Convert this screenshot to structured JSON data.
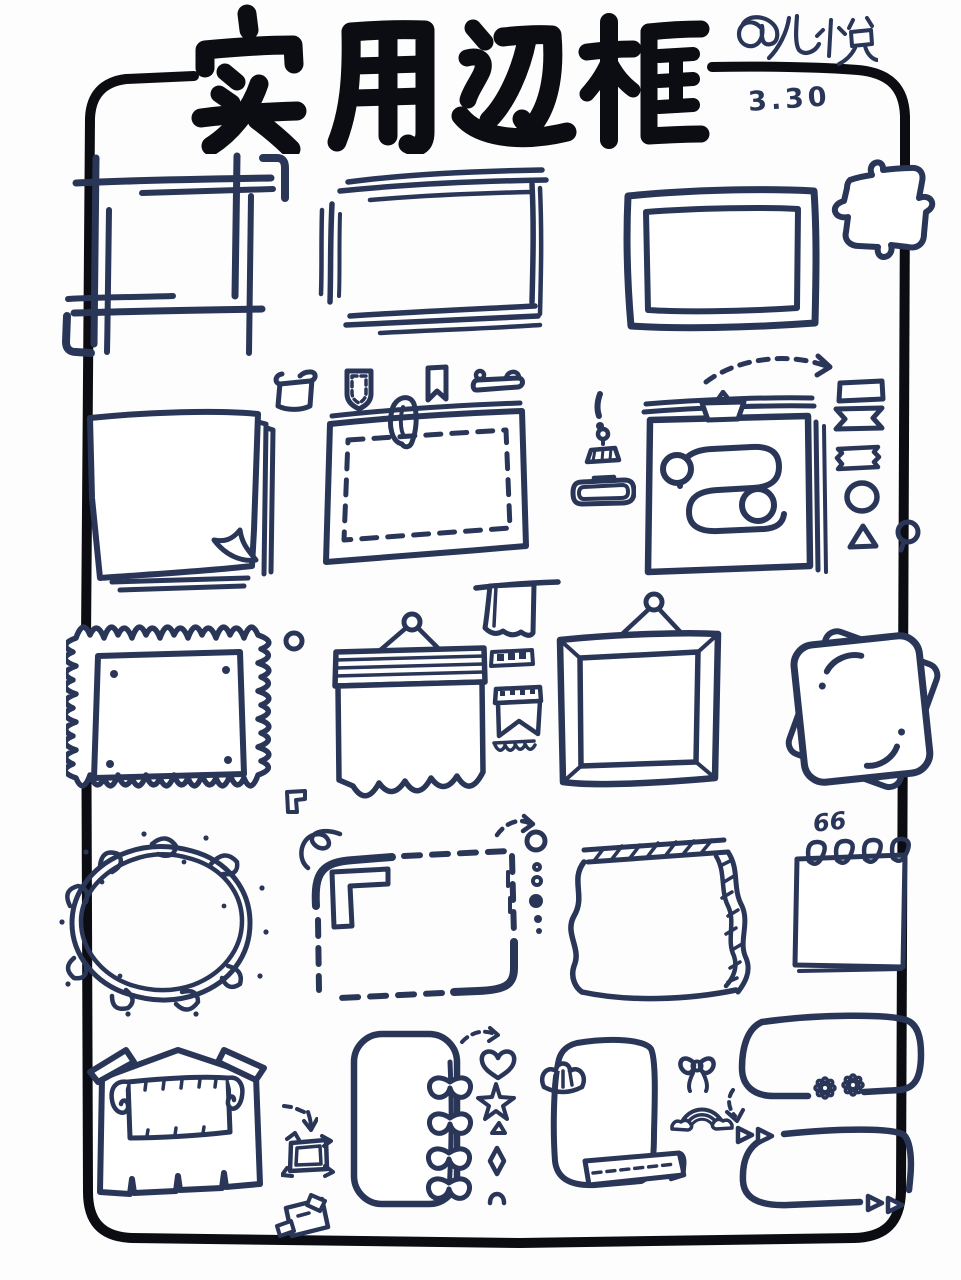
{
  "header": {
    "title": "实用边框",
    "title_meaning": "Practical Borders",
    "author": "@九悦",
    "date": "3.30"
  },
  "quote_pad": {
    "marks": "66"
  },
  "colors": {
    "ink": "#2a3658",
    "outline": "#0c0d12",
    "paper": "#ffffff"
  },
  "doodles": [
    "outer-border",
    "crop-marks-frame",
    "sketch-lines-frame",
    "double-border-frame",
    "puzzle-piece",
    "stacked-paper-frame",
    "scroll-icon",
    "pocket-icon",
    "bookmark-icon",
    "clamp-icon",
    "paperclip-dashed-frame",
    "exclamation-icon",
    "binder-clip-icon",
    "nameplate-icon",
    "collage-frame",
    "dashed-arc-arrow",
    "banner-rect-icon",
    "ribbon-banner-icon",
    "washi-tape-icon",
    "circle-icon",
    "triangle-icon",
    "speech-bubble-icon",
    "stamp-frame",
    "dot-circle-icon",
    "hanging-banner-frame",
    "towel-icon",
    "film-strip-icon",
    "pennant-icon",
    "bunting-icon",
    "picture-frame",
    "rotated-cards-frame",
    "scribble-circle-frame",
    "corner-bracket-icon",
    "curl-squiggle-icon",
    "dashed-corner-frame",
    "dashed-arrow-icon",
    "dots-column",
    "torn-tape-frame",
    "spiral-notepad-frame",
    "house-scroll-frame",
    "dashed-arrow-down-icon",
    "mini-photo-frame-icon",
    "taped-note-icon",
    "vine-frame",
    "heart-icon",
    "star-icon",
    "small-triangle-icon",
    "diamond-icon",
    "arc-icon",
    "shell-ribbon-frame",
    "bow-icon",
    "rainbow-icon",
    "curved-arrow-icon",
    "flower-gap-frame",
    "daisy-icon",
    "arrow-gap-frame",
    "triangle-arrow-icon"
  ]
}
